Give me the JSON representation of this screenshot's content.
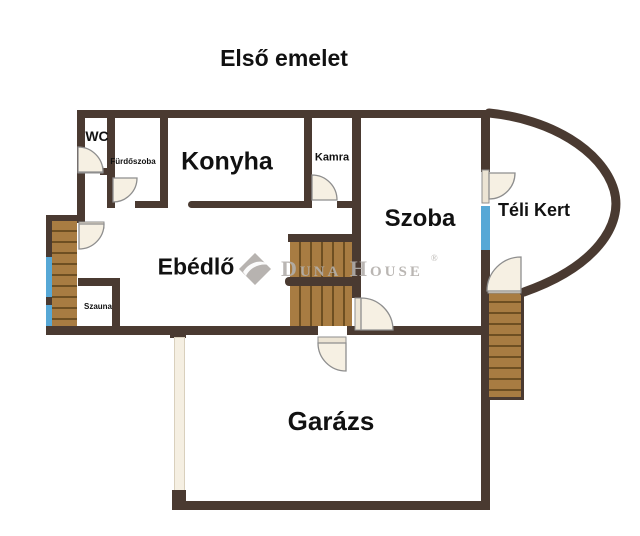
{
  "title": "Első emelet",
  "rooms": {
    "wc": "WC",
    "furdoszoba": "Fürdőszoba",
    "konyha": "Konyha",
    "kamra": "Kamra",
    "szoba": "Szoba",
    "telikert": "Téli Kert",
    "ebedlo": "Ebédlő",
    "szauna": "Szauna",
    "garazs": "Garázs"
  },
  "watermark": {
    "brand": "Duna House",
    "registered": "®"
  },
  "colors": {
    "wall": "#4a3a31",
    "wood": "#a87c42",
    "wood_line": "#6e4f22",
    "window": "#57a8d6",
    "door_fill": "#f6f0e3",
    "door_stroke": "#8e8e8e",
    "light_wall": "#f5efe2",
    "label": "#111111",
    "watermark_gray": "#b3afab",
    "background": "#ffffff"
  }
}
